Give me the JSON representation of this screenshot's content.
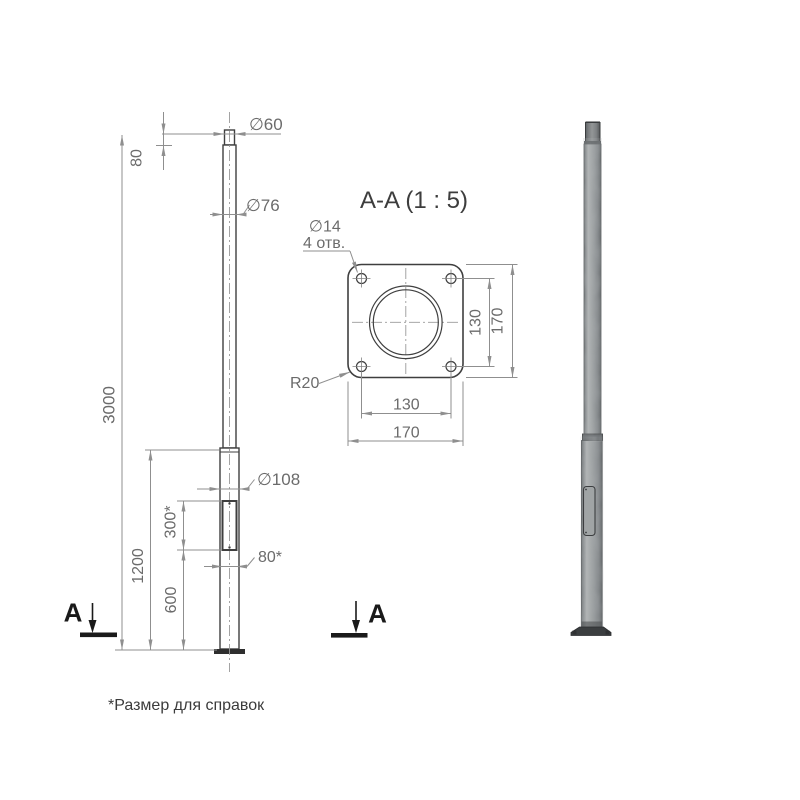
{
  "drawing": {
    "front_view": {
      "dim_top_diameter": "∅60",
      "dim_top_length": "80",
      "dim_mid_diameter": "∅76",
      "dim_total_height": "3000",
      "dim_base_diameter": "∅108",
      "dim_hatch_height": "300*",
      "dim_hatch_width": "80*",
      "dim_lower_section": "1200",
      "dim_hatch_elevation": "600",
      "section_letter": "A"
    },
    "section_view": {
      "title": "A-A (1 : 5)",
      "dim_hole_diameter": "∅14",
      "dim_hole_count": "4 отв.",
      "dim_corner_radius": "R20",
      "dim_bolt_spacing_vertical": "130",
      "dim_plate_height": "170",
      "dim_bolt_spacing_horizontal": "130",
      "dim_plate_width": "170"
    },
    "footnote": "*Размер для справок",
    "colors": {
      "object_line": "#3f3f3f",
      "dimension_line": "#8f8f8f",
      "dimension_text": "#6b6b6b",
      "section_marker": "#1a1a1a",
      "background": "#ffffff",
      "steel_gray": "#9aa0a2"
    }
  }
}
